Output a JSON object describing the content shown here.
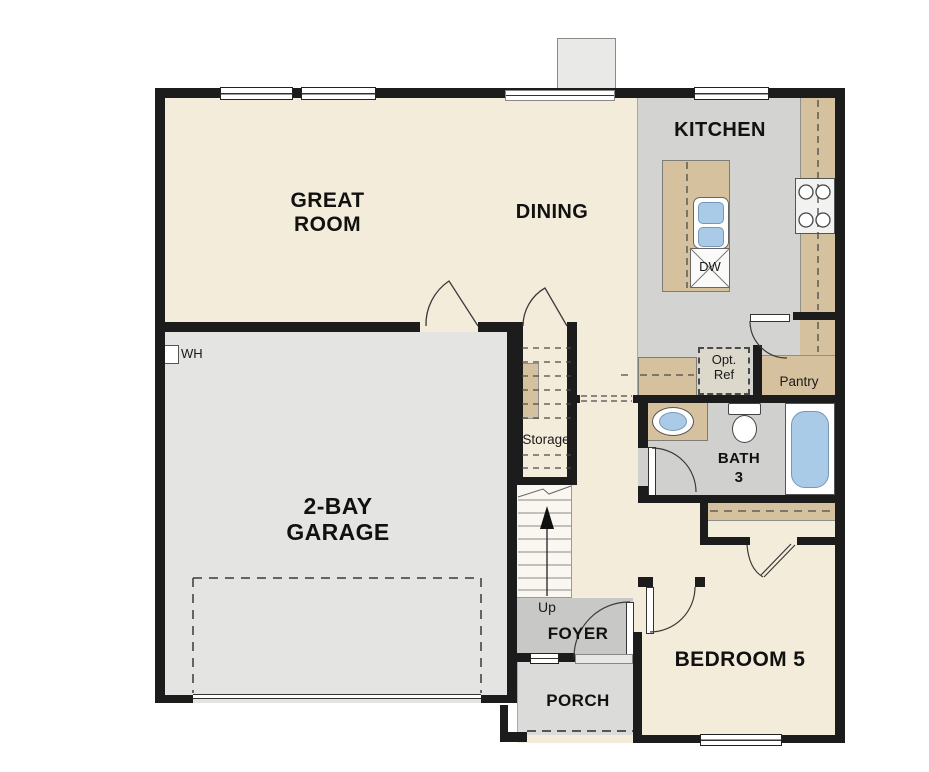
{
  "colors": {
    "wall": "#1c1c1c",
    "floor_cream": "#f4ecda",
    "floor_kitchen": "#d3d3d1",
    "floor_garage": "#e4e4e2",
    "floor_bath": "#d0d0ce",
    "floor_foyer": "#c8c8c6",
    "floor_porch": "#dbdbd9",
    "floor_stairs": "#faf7f0",
    "counter_tan": "#d5c19d",
    "fixture_blue": "#a9cbe8"
  },
  "rooms": {
    "great_room": {
      "label": "GREAT ROOM"
    },
    "dining": {
      "label": "DINING"
    },
    "kitchen": {
      "label": "KITCHEN"
    },
    "garage": {
      "label": "2-BAY GARAGE"
    },
    "storage": {
      "label": "Storage"
    },
    "foyer": {
      "label": "FOYER"
    },
    "porch": {
      "label": "PORCH"
    },
    "bedroom5": {
      "label": "BEDROOM 5"
    },
    "bath3": {
      "label": "BATH 3"
    },
    "pantry": {
      "label": "Pantry"
    }
  },
  "annotations": {
    "up": "Up",
    "wh": "WH",
    "dw": "DW",
    "opt_ref": "Opt. Ref"
  }
}
